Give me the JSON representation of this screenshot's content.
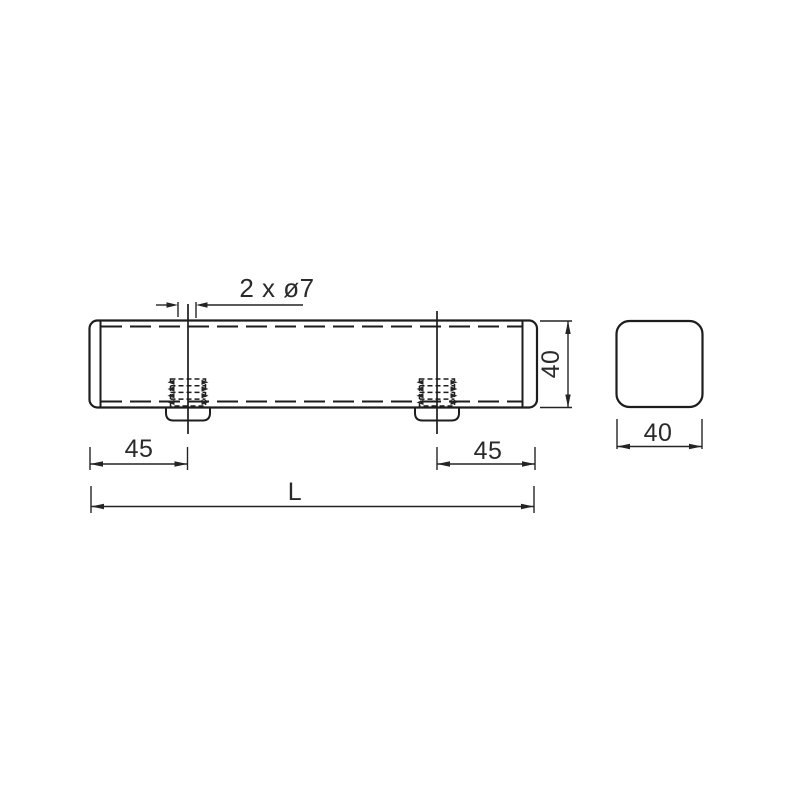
{
  "drawing": {
    "kind": "technical-drawing-two-views",
    "background_color": "#ffffff",
    "line_color": "#1d1d1d",
    "text_color": "#2a2a2a",
    "front_view": {
      "hole_callout": "2 x ø7",
      "left_hole_offset": "45",
      "right_hole_offset": "45",
      "overall_length": "L",
      "profile_height": "40"
    },
    "end_view": {
      "profile_width": "40"
    }
  }
}
